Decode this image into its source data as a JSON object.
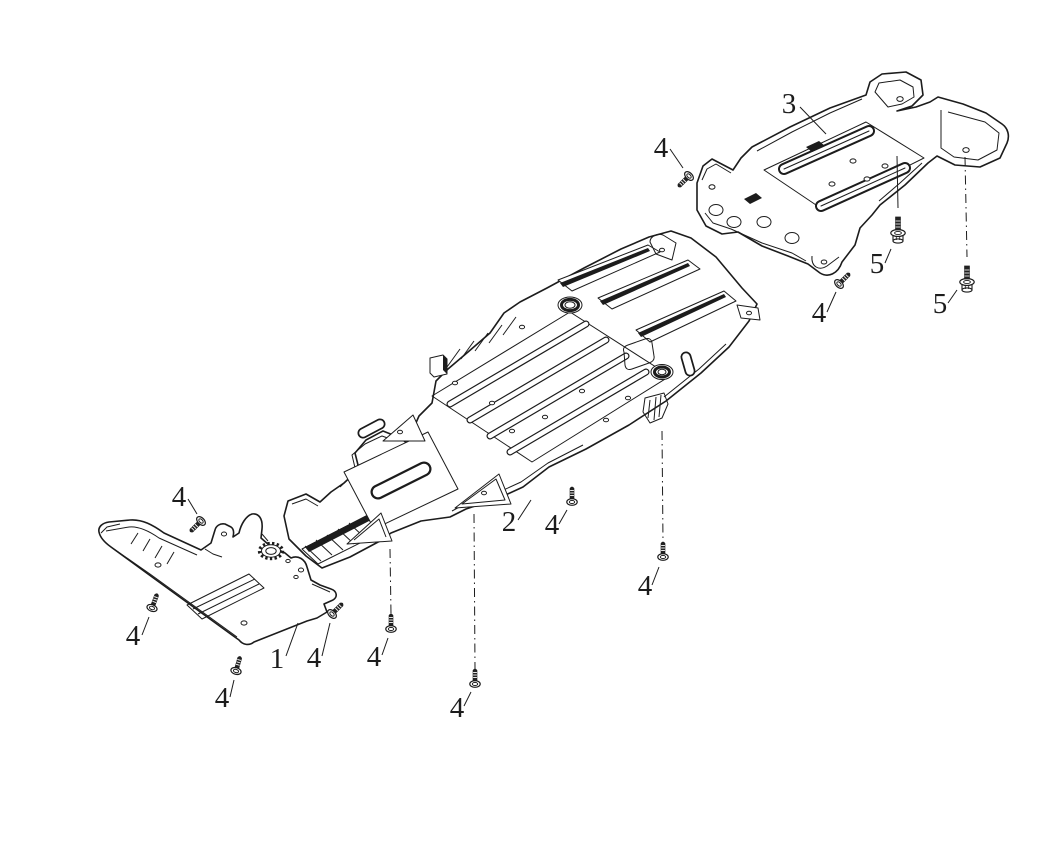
{
  "canvas": {
    "width": 1064,
    "height": 841,
    "background": "#ffffff",
    "line_color": "#1c1c1c"
  },
  "diagram": {
    "type": "exploded-parts-diagram",
    "part_callouts": [
      {
        "label": "1",
        "part_name": "front-skid-plate",
        "label_x": 277,
        "label_y": 668,
        "leader": [
          286,
          656,
          298,
          623
        ]
      },
      {
        "label": "2",
        "part_name": "center-skid-plate",
        "label_x": 509,
        "label_y": 531,
        "leader": [
          518,
          520,
          531,
          500
        ]
      },
      {
        "label": "3",
        "part_name": "rear-skid-plate",
        "label_x": 789,
        "label_y": 113,
        "leader": [
          800,
          107,
          826,
          134
        ]
      }
    ],
    "fastener_callouts": [
      {
        "label": "4",
        "type": "screw",
        "x": 689,
        "y": 176,
        "rot": 45,
        "label_x": 661,
        "label_y": 157,
        "leader": [
          670,
          149,
          683,
          168
        ]
      },
      {
        "label": "4",
        "type": "screw",
        "x": 839,
        "y": 284,
        "rot": 225,
        "label_x": 819,
        "label_y": 322,
        "leader": [
          827,
          312,
          836,
          292
        ]
      },
      {
        "label": "4",
        "type": "screw",
        "x": 201,
        "y": 521,
        "rot": 45,
        "label_x": 179,
        "label_y": 506,
        "leader": [
          188,
          499,
          197,
          514
        ]
      },
      {
        "label": "4",
        "type": "screw",
        "x": 152,
        "y": 608,
        "rot": 200,
        "label_x": 133,
        "label_y": 645,
        "leader": [
          142,
          635,
          149,
          617
        ]
      },
      {
        "label": "4",
        "type": "screw",
        "x": 236,
        "y": 671,
        "rot": 196,
        "label_x": 222,
        "label_y": 707,
        "leader": [
          230,
          697,
          234,
          680
        ]
      },
      {
        "label": "4",
        "type": "screw",
        "x": 332,
        "y": 614,
        "rot": 225,
        "label_x": 314,
        "label_y": 667,
        "leader": [
          322,
          656,
          330,
          623
        ]
      },
      {
        "label": "4",
        "type": "screw",
        "x": 391,
        "y": 629,
        "rot": 180,
        "label_x": 374,
        "label_y": 666,
        "leader": [
          382,
          655,
          388,
          638
        ],
        "guide": [
          390,
          549,
          391,
          614
        ],
        "guide_style": "dashdot"
      },
      {
        "label": "4",
        "type": "screw",
        "x": 475,
        "y": 684,
        "rot": 180,
        "label_x": 457,
        "label_y": 717,
        "leader": [
          464,
          706,
          471,
          692
        ],
        "guide": [
          474,
          514,
          475,
          669
        ],
        "guide_style": "dashdot"
      },
      {
        "label": "4",
        "type": "screw",
        "x": 572,
        "y": 502,
        "rot": 180,
        "label_x": 552,
        "label_y": 534,
        "leader": [
          559,
          524,
          567,
          510
        ]
      },
      {
        "label": "4",
        "type": "screw",
        "x": 663,
        "y": 557,
        "rot": 180,
        "label_x": 645,
        "label_y": 595,
        "leader": [
          652,
          585,
          659,
          567
        ],
        "guide": [
          662,
          431,
          663,
          542
        ],
        "guide_style": "dashdot"
      },
      {
        "label": "5",
        "type": "bolt",
        "x": 898,
        "y": 232,
        "rot": 180,
        "label_x": 877,
        "label_y": 273,
        "leader": [
          885,
          263,
          891,
          249
        ],
        "guide": [
          897,
          156,
          898,
          208
        ],
        "guide_style": "solid"
      },
      {
        "label": "5",
        "type": "bolt",
        "x": 967,
        "y": 281,
        "rot": 180,
        "label_x": 940,
        "label_y": 313,
        "leader": [
          948,
          303,
          957,
          290
        ],
        "guide": [
          965,
          157,
          967,
          257
        ],
        "guide_style": "dashdot"
      }
    ]
  }
}
